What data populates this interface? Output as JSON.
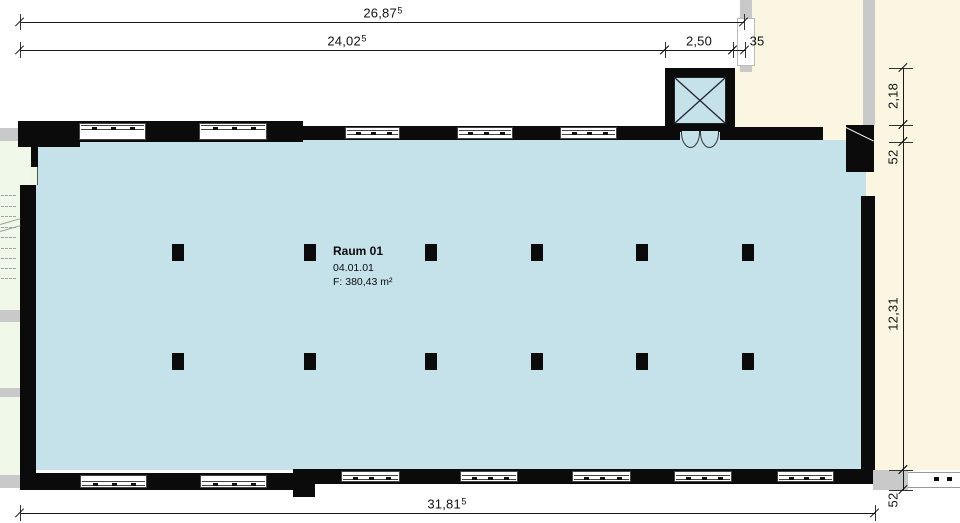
{
  "app": {
    "type": "architectural-floor-plan"
  },
  "room_label": {
    "name": "Raum 01",
    "number": "04.01.01",
    "area": "F: 380,43 m²"
  },
  "colors": {
    "room_fill": "#c5e2ea",
    "adjacent_fill": "#faf6e2",
    "stairwell_fill": "#f0f8ea",
    "wall": "#0b0b0b",
    "secondary_wall": "#c9c9c9"
  },
  "dimensions": [
    {
      "id": "total-top",
      "type": "h",
      "y": 22,
      "x1": 20,
      "x2": 744,
      "text": "26,87",
      "sup": "5",
      "lx": 383,
      "ly": 13
    },
    {
      "id": "inner-top",
      "type": "h",
      "y": 50,
      "x1": 20,
      "x2": 665,
      "text": "24,02",
      "sup": "5",
      "lx": 347,
      "ly": 41
    },
    {
      "id": "elevator-width",
      "type": "h",
      "y": 50,
      "x1": 665,
      "x2": 733,
      "text": "2,50",
      "lx": 699,
      "ly": 41
    },
    {
      "id": "wall-thickness-top",
      "type": "h",
      "y": 50,
      "x1": 733,
      "x2": 745,
      "text": "35",
      "lx": 757,
      "ly": 41
    },
    {
      "id": "total-bottom",
      "type": "h",
      "y": 513,
      "x1": 20,
      "x2": 875,
      "text": "31,81",
      "sup": "5",
      "lx": 447,
      "ly": 504
    },
    {
      "id": "right-top",
      "type": "v",
      "x": 903,
      "y1": 68,
      "y2": 125,
      "text": "2,18",
      "lx": 893,
      "ly": 96
    },
    {
      "id": "right-wall-a",
      "type": "v",
      "x": 903,
      "y1": 125,
      "y2": 142,
      "text": "52",
      "lx": 893,
      "ly": 157
    },
    {
      "id": "room-depth",
      "type": "v",
      "x": 903,
      "y1": 142,
      "y2": 470,
      "text": "12,31",
      "lx": 893,
      "ly": 314
    },
    {
      "id": "right-wall-b",
      "type": "v",
      "x": 903,
      "y1": 470,
      "y2": 490,
      "text": "52",
      "lx": 893,
      "ly": 500
    }
  ],
  "plan": {
    "rects": [
      {
        "name": "adjacent-area-background",
        "c": "cream",
        "x": 733,
        "y": 0,
        "w": 227,
        "h": 470
      },
      {
        "name": "dim-area-white-patch",
        "c": "white",
        "x": 726,
        "y": 0,
        "w": 14,
        "h": 68
      },
      {
        "name": "stairwell-background",
        "c": "green",
        "x": 0,
        "y": 128,
        "w": 20,
        "h": 347
      },
      {
        "name": "stairwell-background-upper",
        "c": "green",
        "x": 20,
        "y": 147,
        "w": 11,
        "h": 38
      },
      {
        "name": "room-01-floor",
        "c": "blue",
        "x": 36,
        "y": 140,
        "w": 826,
        "h": 330
      },
      {
        "name": "right-opening-floor",
        "c": "blue",
        "x": 861,
        "y": 172,
        "w": 5,
        "h": 24
      },
      {
        "name": "corridor-wall-strip",
        "c": "gray",
        "x": 740,
        "y": 0,
        "w": 12,
        "h": 72
      },
      {
        "name": "corridor-wall-window",
        "c": "whiteb",
        "x": 737,
        "y": 18,
        "w": 18,
        "h": 48
      },
      {
        "name": "adjacent-wall-strip",
        "c": "gray",
        "x": 863,
        "y": 0,
        "w": 12,
        "h": 125
      },
      {
        "name": "left-gray-block-top",
        "c": "gray",
        "x": 0,
        "y": 128,
        "w": 18,
        "h": 13
      },
      {
        "name": "left-gray-block-mid",
        "c": "gray",
        "x": 0,
        "y": 310,
        "w": 20,
        "h": 12
      },
      {
        "name": "left-gray-block-mid2",
        "c": "gray",
        "x": 0,
        "y": 388,
        "w": 20,
        "h": 9
      },
      {
        "name": "left-gray-block-bottom",
        "c": "gray",
        "x": 0,
        "y": 475,
        "w": 20,
        "h": 13
      },
      {
        "name": "bottom-right-gray-block",
        "c": "gray",
        "x": 873,
        "y": 470,
        "w": 35,
        "h": 20
      },
      {
        "name": "wall-top-left",
        "c": "black",
        "x": 18,
        "y": 121,
        "w": 285,
        "h": 21
      },
      {
        "name": "wall-top-left-corner",
        "c": "black",
        "x": 18,
        "y": 121,
        "w": 62,
        "h": 26
      },
      {
        "name": "wall-top-mid",
        "c": "black",
        "x": 303,
        "y": 126,
        "w": 362,
        "h": 14
      },
      {
        "name": "wall-top-right",
        "c": "black",
        "x": 735,
        "y": 127,
        "w": 88,
        "h": 13
      },
      {
        "name": "wall-left-stub",
        "c": "black",
        "x": 31,
        "y": 147,
        "w": 7,
        "h": 20
      },
      {
        "name": "stair-door-opening",
        "c": "green2",
        "x": 31,
        "y": 167,
        "w": 7,
        "h": 18
      },
      {
        "name": "wall-left",
        "c": "black",
        "x": 20,
        "y": 185,
        "w": 16,
        "h": 305
      },
      {
        "name": "wall-bottom-left",
        "c": "black",
        "x": 36,
        "y": 473,
        "w": 279,
        "h": 17
      },
      {
        "name": "wall-bottom-step",
        "c": "black",
        "x": 293,
        "y": 469,
        "w": 22,
        "h": 28
      },
      {
        "name": "wall-bottom-right",
        "c": "black",
        "x": 315,
        "y": 469,
        "w": 558,
        "h": 15
      },
      {
        "name": "wall-right",
        "c": "black",
        "x": 861,
        "y": 196,
        "w": 14,
        "h": 274
      },
      {
        "name": "wall-right-corner",
        "c": "black",
        "x": 846,
        "y": 125,
        "w": 28,
        "h": 47,
        "diag": true
      },
      {
        "name": "facade-band-right",
        "c": "band",
        "x": 908,
        "y": 472,
        "w": 52,
        "h": 16
      },
      {
        "name": "facade-band-tick",
        "c": "black",
        "x": 934,
        "y": 477,
        "w": 5,
        "h": 4
      },
      {
        "name": "facade-band-tick",
        "c": "black",
        "x": 947,
        "y": 477,
        "w": 5,
        "h": 4
      }
    ],
    "windows": [
      {
        "x": 79,
        "y": 123,
        "w": 67,
        "h": 17,
        "band": "top"
      },
      {
        "x": 199,
        "y": 123,
        "w": 68,
        "h": 17,
        "band": "top"
      },
      {
        "x": 345,
        "y": 127,
        "w": 55,
        "h": 12,
        "band": "mid"
      },
      {
        "x": 457,
        "y": 127,
        "w": 56,
        "h": 12,
        "band": "mid"
      },
      {
        "x": 560,
        "y": 127,
        "w": 57,
        "h": 12,
        "band": "mid"
      },
      {
        "x": 80,
        "y": 475,
        "w": 67,
        "h": 13,
        "band": "bottom"
      },
      {
        "x": 200,
        "y": 475,
        "w": 67,
        "h": 13,
        "band": "bottom"
      },
      {
        "x": 341,
        "y": 471,
        "w": 59,
        "h": 11,
        "band": "bottom"
      },
      {
        "x": 460,
        "y": 471,
        "w": 58,
        "h": 11,
        "band": "bottom"
      },
      {
        "x": 572,
        "y": 471,
        "w": 59,
        "h": 11,
        "band": "bottom"
      },
      {
        "x": 674,
        "y": 471,
        "w": 58,
        "h": 11,
        "band": "bottom"
      },
      {
        "x": 777,
        "y": 471,
        "w": 57,
        "h": 11,
        "band": "bottom"
      }
    ],
    "columns": {
      "xs": [
        172,
        304,
        425,
        531,
        636,
        742
      ],
      "rows": [
        244,
        353
      ],
      "w": 12,
      "h": 17
    },
    "stairs": {
      "tread_x": 1,
      "tread_w": 15,
      "tread_ys": [
        195,
        206,
        216,
        227,
        237,
        248,
        258,
        268,
        278
      ],
      "diagonals": [
        {
          "x": 0,
          "y": 224
        },
        {
          "x": 0,
          "y": 231
        }
      ]
    },
    "elevator": {
      "frame": {
        "x": 665,
        "y": 68,
        "w": 70,
        "h": 72
      },
      "interior": {
        "x": 674,
        "y": 77,
        "w": 52,
        "h": 47
      },
      "gap": {
        "x": 680,
        "y": 132,
        "w": 40,
        "h": 8
      },
      "leaves": [
        {
          "x": 681,
          "y": 131,
          "w": 19,
          "h": 17
        },
        {
          "x": 700,
          "y": 131,
          "w": 19,
          "h": 17
        }
      ]
    }
  }
}
